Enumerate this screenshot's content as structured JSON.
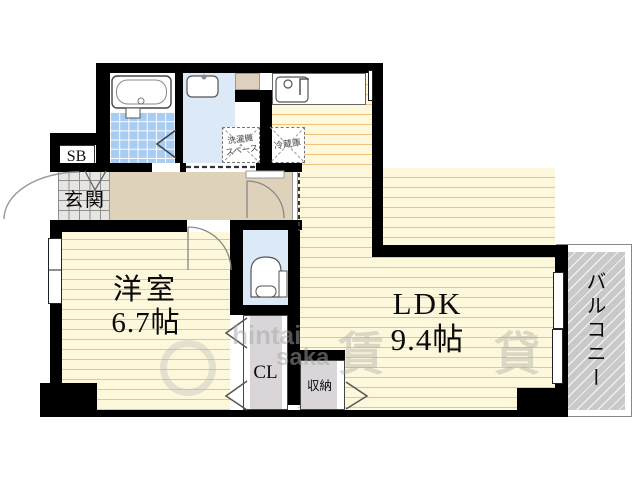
{
  "rooms": {
    "western_room": {
      "label": "洋室",
      "size": "6.7帖"
    },
    "ldk": {
      "label": "LDK",
      "size": "9.4帖"
    },
    "balcony": {
      "label": "バルコニー"
    },
    "entrance": {
      "label": "玄関"
    },
    "shoe_box": {
      "label": "SB"
    },
    "closet": {
      "label": "CL"
    },
    "storage": {
      "label": "収納"
    },
    "washer_space": {
      "line1": "洗濯機",
      "line2": "スペース"
    },
    "refrigerator": {
      "label": "冷蔵庫"
    }
  },
  "watermark": {
    "latin_top": "hintai",
    "latin_bottom": "saka",
    "kanji": "賃貸"
  },
  "colors": {
    "wall": "#000000",
    "floor_yellow": "#fdf8dc",
    "floor_stripe": "#f0c27d",
    "bath_tile_blue": "#a9ccf1",
    "wet_room_blue": "#dce9f6",
    "hallway_beige": "#ded2bb",
    "closet_gray": "#d9d5d9",
    "balcony_gray": "#c9c9c9"
  }
}
